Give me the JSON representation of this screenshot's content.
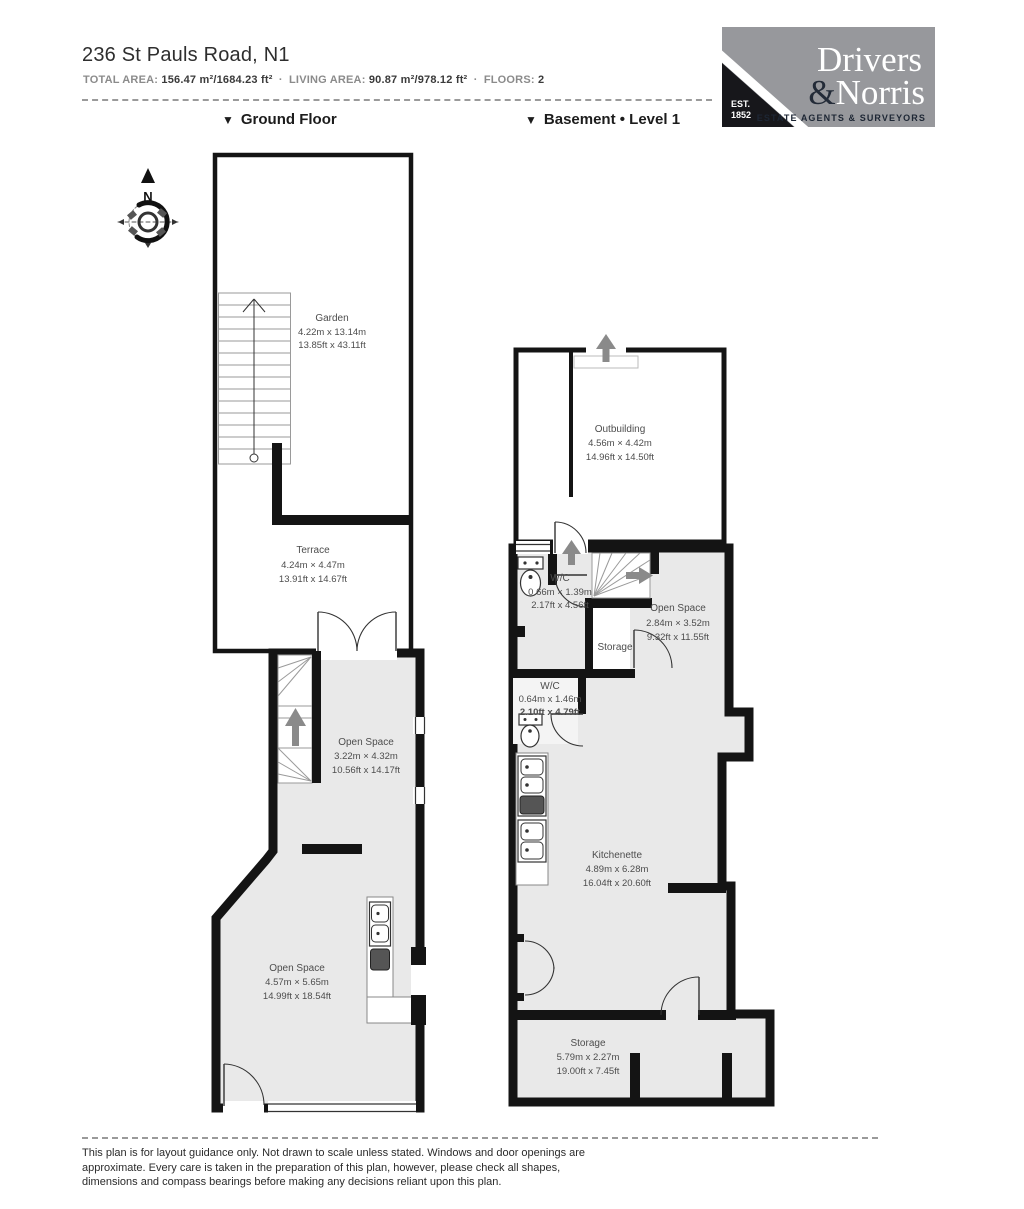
{
  "header": {
    "title": "236 St Pauls Road, N1",
    "stats": {
      "total_label": "TOTAL AREA:",
      "total_value": "156.47 m²/1684.23 ft²",
      "sep1": "·",
      "living_label": "LIVING AREA:",
      "living_value": "90.87 m²/978.12 ft²",
      "sep2": "·",
      "floors_label": "FLOORS:",
      "floors_value": "2"
    }
  },
  "logo": {
    "name_line1": "Drivers",
    "amp": "&",
    "name_line2": "Norris",
    "est_line1": "EST.",
    "est_line2": "1852",
    "tagline": "ESTATE AGENTS & SURVEYORS"
  },
  "floors": {
    "ground": {
      "marker": "▼",
      "label": "Ground Floor"
    },
    "basement": {
      "marker": "▼",
      "label": "Basement • Level 1"
    }
  },
  "compass": {
    "north_label": "N"
  },
  "rooms": {
    "garden": {
      "name": "Garden",
      "metric": "4.22m x 13.14m",
      "imperial": "13.85ft x 43.11ft"
    },
    "terrace": {
      "name": "Terrace",
      "metric": "4.24m × 4.47m",
      "imperial": "13.91ft x 14.67ft"
    },
    "open_space_upper": {
      "name": "Open Space",
      "metric": "3.22m × 4.32m",
      "imperial": "10.56ft x 14.17ft"
    },
    "open_space_lower": {
      "name": "Open Space",
      "metric": "4.57m × 5.65m",
      "imperial": "14.99ft x 18.54ft"
    },
    "outbuilding": {
      "name": "Outbuilding",
      "metric": "4.56m × 4.42m",
      "imperial": "14.96ft x 14.50ft"
    },
    "wc_upper": {
      "name": "W/C",
      "metric": "0.66m × 1.39m",
      "imperial": "2.17ft x 4.56ft"
    },
    "open_space_basement": {
      "name": "Open Space",
      "metric": "2.84m × 3.52m",
      "imperial": "9.32ft x 11.55ft"
    },
    "storage_mid": {
      "name": "Storage"
    },
    "wc_mid": {
      "name": "W/C",
      "metric": "0.64m x 1.46m",
      "imperial": "2.10ft x 4.79ft"
    },
    "kitchenette": {
      "name": "Kitchenette",
      "metric": "4.89m x 6.28m",
      "imperial": "16.04ft x 20.60ft"
    },
    "storage_bottom": {
      "name": "Storage",
      "metric": "5.79m x 2.27m",
      "imperial": "19.00ft x 7.45ft"
    }
  },
  "footer": {
    "disclaimer": "This plan is for layout guidance only. Not drawn to scale unless stated. Windows and door openings are approximate. Every care is taken in the preparation of this plan, however, please check all shapes, dimensions and compass bearings before making any decisions reliant upon this plan."
  },
  "colors": {
    "wall": "#141414",
    "room_fill": "#e9e9e9",
    "arrow_gray": "#8a8a8a",
    "logo_gray": "#97989c",
    "logo_dark": "#1b222e"
  }
}
